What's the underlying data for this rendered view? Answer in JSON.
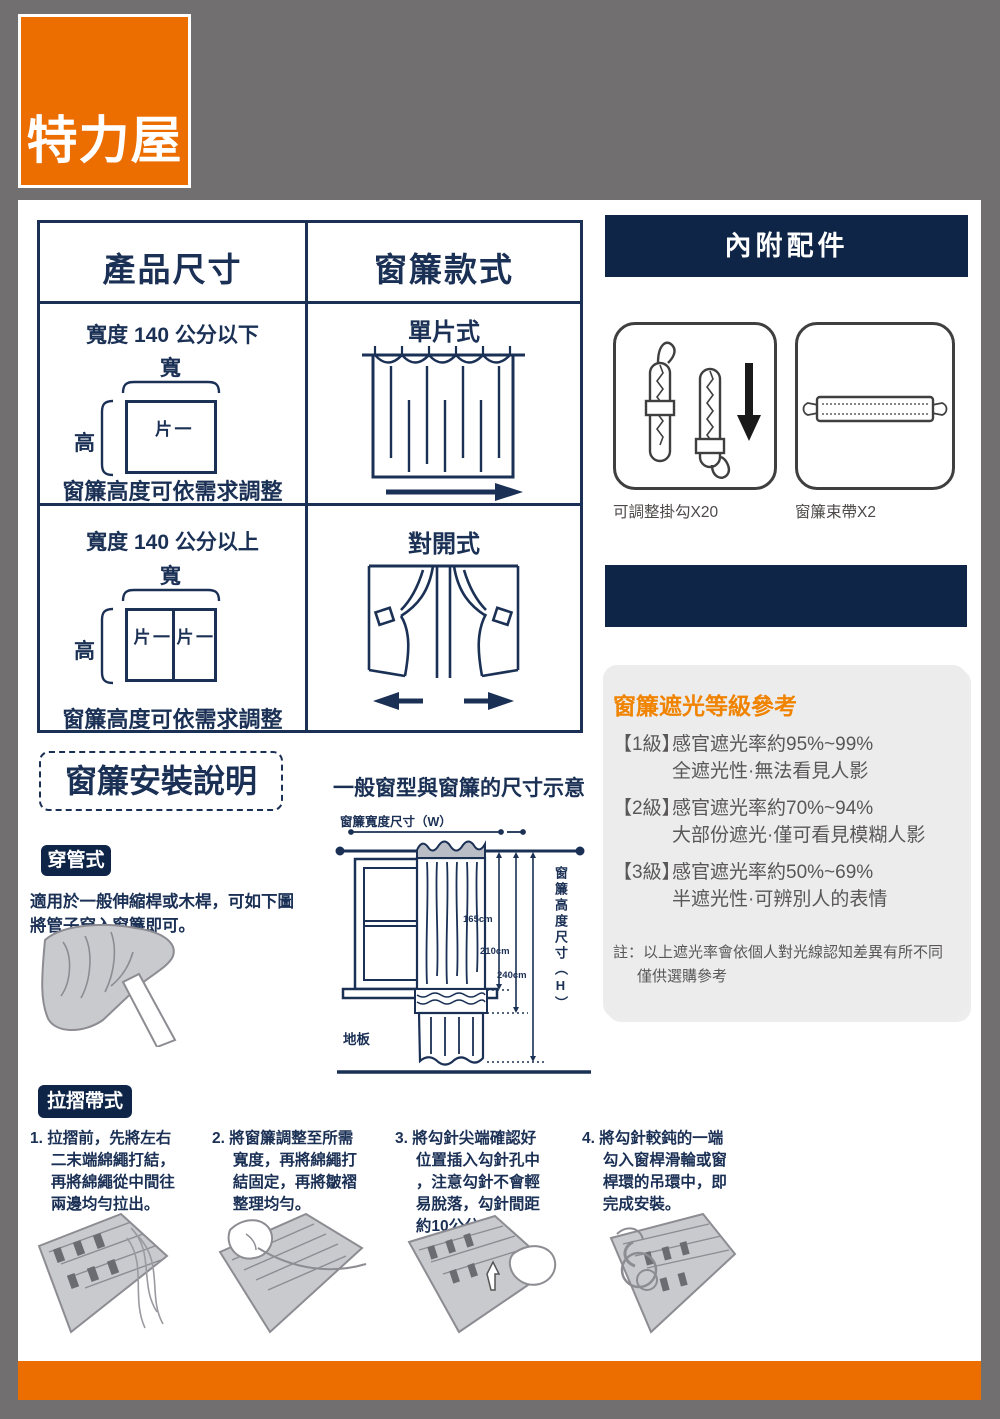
{
  "colors": {
    "brand_orange": "#EC6D00",
    "heading_orange": "#F08300",
    "navy": "#1B3055",
    "bar_navy": "#0F2547",
    "sheet_bg": "#FFFFFF",
    "page_bg": "#716F6F",
    "panel_gray": "#ECECEC"
  },
  "logo": {
    "text": "特力屋"
  },
  "size_table": {
    "headers": [
      "產品尺寸",
      "窗簾款式"
    ],
    "rows": [
      {
        "size_title": "寬度 140 公分以下",
        "width_label": "寬",
        "height_label": "高",
        "piece_labels": [
          "一片"
        ],
        "note": "窗簾高度可依需求調整",
        "style_name": "單片式"
      },
      {
        "size_title": "寬度 140 公分以上",
        "width_label": "寬",
        "height_label": "高",
        "piece_labels": [
          "一片",
          "一片"
        ],
        "note": "窗簾高度可依需求調整",
        "style_name": "對開式"
      }
    ]
  },
  "accessories": {
    "title": "內附配件",
    "items": [
      {
        "icon": "curtain-hooks",
        "label": "可調整掛勾X20"
      },
      {
        "icon": "tie-band",
        "label": "窗簾束帶X2"
      }
    ]
  },
  "shading": {
    "title": "窗簾遮光等級參考",
    "levels": [
      {
        "grade": "【1級】",
        "rate": "感官遮光率約95%~99%",
        "desc": "全遮光性·無法看見人影"
      },
      {
        "grade": "【2級】",
        "rate": "感官遮光率約70%~94%",
        "desc": "大部份遮光·僅可看見模糊人影"
      },
      {
        "grade": "【3級】",
        "rate": "感官遮光率約50%~69%",
        "desc": "半遮光性·可辨別人的表情"
      }
    ],
    "note": "註：以上遮光率會依個人對光線認知差異有所不同\n僅供選購參考"
  },
  "install": {
    "title": "窗簾安裝說明",
    "diagram_title": "一般窗型與窗簾的尺寸示意",
    "width_dim_label": "窗簾寬度尺寸（W）",
    "height_dim_label": "窗簾高度尺寸（H）",
    "dims": [
      "165cm",
      "210cm",
      "240cm"
    ],
    "floor_label": "地板",
    "rod_method": {
      "badge": "穿管式",
      "desc": "適用於一般伸縮桿或木桿，可如下圖\n將管子穿入窗簾即可。"
    },
    "pleat_method": {
      "badge": "拉摺帶式",
      "steps": [
        "1. 拉摺前，先將左右\n二末端綿繩打結，\n再將綿繩從中間往\n兩邊均勻拉出。",
        "2. 將窗簾調整至所需\n寬度，再將綿繩打\n結固定，再將皺褶\n整理均勻。",
        "3. 將勾針尖端確認好\n位置插入勾針孔中\n，注意勾針不會輕\n易脫落，勾針間距\n約10公分。",
        "4. 將勾針較鈍的一端\n勾入窗桿滑輪或窗\n桿環的吊環中，即\n完成安裝。"
      ]
    }
  }
}
